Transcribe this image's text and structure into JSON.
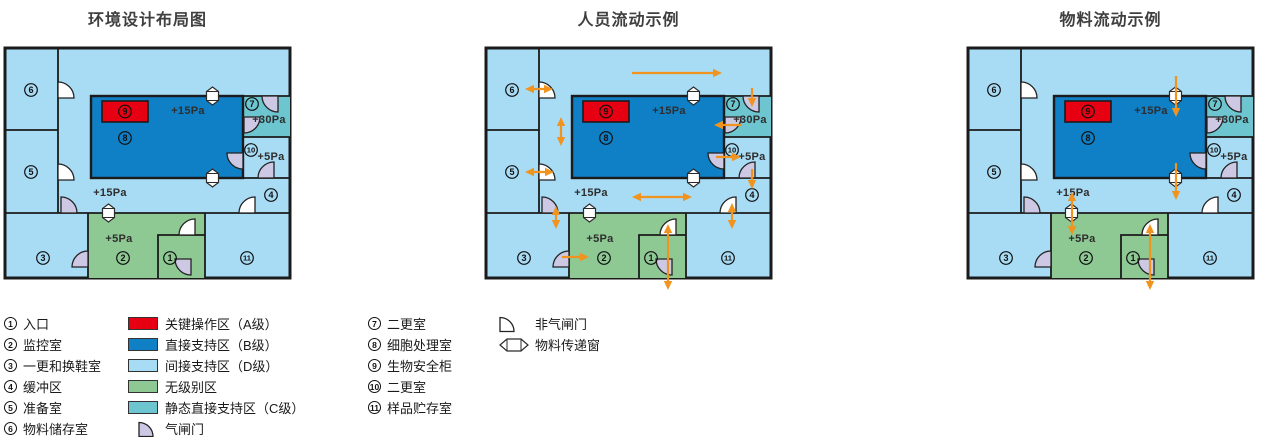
{
  "panels": [
    {
      "title": "环境设计布局图",
      "arrows": []
    },
    {
      "title": "人员流动示例",
      "arrows": [
        {
          "name": "corridor-top-flow",
          "x1": 146,
          "y1": 25,
          "x2": 236,
          "y2": 25,
          "heads": "end"
        },
        {
          "name": "room6-door-flow",
          "x1": 39,
          "y1": 41,
          "x2": 67,
          "y2": 41,
          "heads": "both"
        },
        {
          "name": "left-corridor-flow",
          "x1": 75,
          "y1": 69,
          "x2": 75,
          "y2": 98,
          "heads": "both"
        },
        {
          "name": "into-room7-flow",
          "x1": 266,
          "y1": 40,
          "x2": 266,
          "y2": 59,
          "heads": "end"
        },
        {
          "name": "room7-to-room8-flow",
          "x1": 256,
          "y1": 77,
          "x2": 228,
          "y2": 77,
          "heads": "end"
        },
        {
          "name": "room8-to-room10-flow",
          "x1": 230,
          "y1": 109,
          "x2": 255,
          "y2": 109,
          "heads": "end"
        },
        {
          "name": "room10-to-corridor-flow",
          "x1": 266,
          "y1": 121,
          "x2": 266,
          "y2": 141,
          "heads": "end"
        },
        {
          "name": "room5-door-flow",
          "x1": 39,
          "y1": 124,
          "x2": 68,
          "y2": 124,
          "heads": "both"
        },
        {
          "name": "corridor-flow",
          "x1": 146,
          "y1": 149,
          "x2": 206,
          "y2": 149,
          "heads": "both"
        },
        {
          "name": "corridor-room3-flow",
          "x1": 70,
          "y1": 158,
          "x2": 70,
          "y2": 181,
          "heads": "both"
        },
        {
          "name": "room3-to-room2-flow",
          "x1": 76,
          "y1": 209,
          "x2": 103,
          "y2": 209,
          "heads": "end"
        },
        {
          "name": "entrance-flow",
          "x1": 182,
          "y1": 176,
          "x2": 182,
          "y2": 242,
          "heads": "both"
        },
        {
          "name": "corridor-room11-flow",
          "x1": 246,
          "y1": 155,
          "x2": 246,
          "y2": 181,
          "heads": "both"
        }
      ]
    },
    {
      "title": "物料流动示例",
      "arrows": [
        {
          "name": "window-into-room8-flow",
          "x1": 208,
          "y1": 28,
          "x2": 208,
          "y2": 69,
          "heads": "end"
        },
        {
          "name": "room8-to-corridor-window-flow",
          "x1": 208,
          "y1": 115,
          "x2": 208,
          "y2": 152,
          "heads": "end"
        },
        {
          "name": "corridor-room2-window-flow",
          "x1": 104,
          "y1": 144,
          "x2": 104,
          "y2": 187,
          "heads": "both"
        },
        {
          "name": "entrance-flow",
          "x1": 182,
          "y1": 176,
          "x2": 182,
          "y2": 242,
          "heads": "both"
        }
      ]
    }
  ],
  "plan": {
    "rooms": {
      "r1": "1",
      "r2": "2",
      "r3": "3",
      "r4": "4",
      "r5": "5",
      "r6": "6",
      "r7": "7",
      "r8": "8",
      "r9": "9",
      "r10": "10",
      "r11": "11"
    },
    "pressures": {
      "room8": "+15Pa",
      "room7": "+30Pa",
      "room10": "+5Pa",
      "corridor": "+15Pa",
      "room2": "+5Pa"
    }
  },
  "legend": {
    "col1": [
      {
        "num": "1",
        "label": "入口"
      },
      {
        "num": "2",
        "label": "监控室"
      },
      {
        "num": "3",
        "label": "一更和换鞋室"
      },
      {
        "num": "4",
        "label": "缓冲区"
      },
      {
        "num": "5",
        "label": "准备室"
      },
      {
        "num": "6",
        "label": "物料储存室"
      }
    ],
    "col2": [
      {
        "type": "swatch",
        "color_key": "red",
        "label": "关键操作区（A级）"
      },
      {
        "type": "swatch",
        "color_key": "blue",
        "label": "直接支持区（B级）"
      },
      {
        "type": "swatch",
        "color_key": "lightblue",
        "label": "间接支持区（D级）"
      },
      {
        "type": "swatch",
        "color_key": "green",
        "label": "无级别区"
      },
      {
        "type": "swatch",
        "color_key": "teal",
        "label": "静态直接支持区（C级）"
      },
      {
        "type": "door-airlock",
        "label": "气闸门"
      }
    ],
    "col3": [
      {
        "num": "7",
        "label": "二更室"
      },
      {
        "num": "8",
        "label": "细胞处理室"
      },
      {
        "num": "9",
        "label": "生物安全柜"
      },
      {
        "num": "10",
        "label": "二更室"
      },
      {
        "num": "11",
        "label": "样品贮存室"
      }
    ],
    "col4": [
      {
        "type": "door-plain",
        "label": "非气闸门"
      },
      {
        "type": "transfer-window",
        "label": "物料传递窗"
      }
    ]
  },
  "colors": {
    "red": "#e60012",
    "blue": "#0f7fc6",
    "lightblue": "#a8dbf4",
    "green": "#8ec893",
    "teal": "#6cc5cf",
    "lavender": "#cdc8e4",
    "orange": "#f0941f",
    "wall": "#1b1b1b",
    "text": "#2e2e2e",
    "title": "#3f3f3f"
  }
}
